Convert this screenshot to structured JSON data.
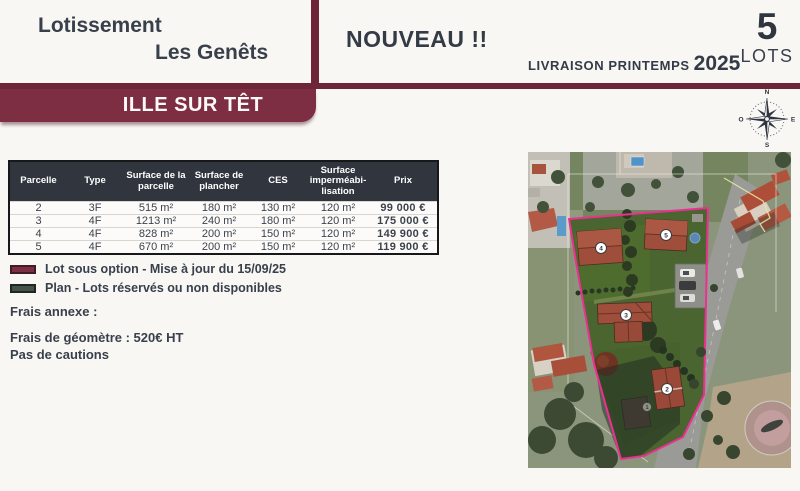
{
  "header": {
    "title_line1": "Lotissement",
    "title_line2": "Les Genêts",
    "badge_new": "NOUVEAU !!",
    "delivery_label": "LIVRAISON PRINTEMPS",
    "delivery_year": "2025",
    "lots_count": "5",
    "lots_label": "LOTS",
    "city_banner": "ILLE SUR TÊT"
  },
  "compass": {
    "north": "N",
    "south": "S",
    "east": "E",
    "west": "O"
  },
  "table": {
    "columns": [
      "Parcelle",
      "Type",
      "Surface de la parcelle",
      "Surface de plancher",
      "CES",
      "Surface imperméabi-lisation",
      "Prix"
    ],
    "rows": [
      [
        "2",
        "3F",
        "515 m²",
        "180 m²",
        "130 m²",
        "120 m²",
        "99 000 €"
      ],
      [
        "3",
        "4F",
        "1213 m²",
        "240 m²",
        "180 m²",
        "120 m²",
        "175 000 €"
      ],
      [
        "4",
        "4F",
        "828 m²",
        "200 m²",
        "150 m²",
        "120 m²",
        "149 900 €"
      ],
      [
        "5",
        "4F",
        "670 m²",
        "200 m²",
        "150 m²",
        "120 m²",
        "119 900 €"
      ]
    ]
  },
  "legend": {
    "items": [
      {
        "label": "Lot sous option - Mise à jour du 15/09/25",
        "color": "#7d2e42"
      },
      {
        "label": "Plan - Lots réservés ou non disponibles",
        "color": "#44524a"
      }
    ]
  },
  "notes": {
    "fees_title": "Frais annexe :",
    "fee_line1": "Frais de géomètre : 520€ HT",
    "fee_line2": "Pas de cautions"
  },
  "map": {
    "badges": {
      "b1": "1",
      "b2": "2",
      "b3": "3",
      "b4": "4",
      "b5": "5"
    },
    "boundary_color": "#ee2f92"
  },
  "colors": {
    "maroon": "#7d2e42",
    "dark_bar": "#6e2537",
    "charcoal": "#30353e",
    "text": "#39404b"
  }
}
